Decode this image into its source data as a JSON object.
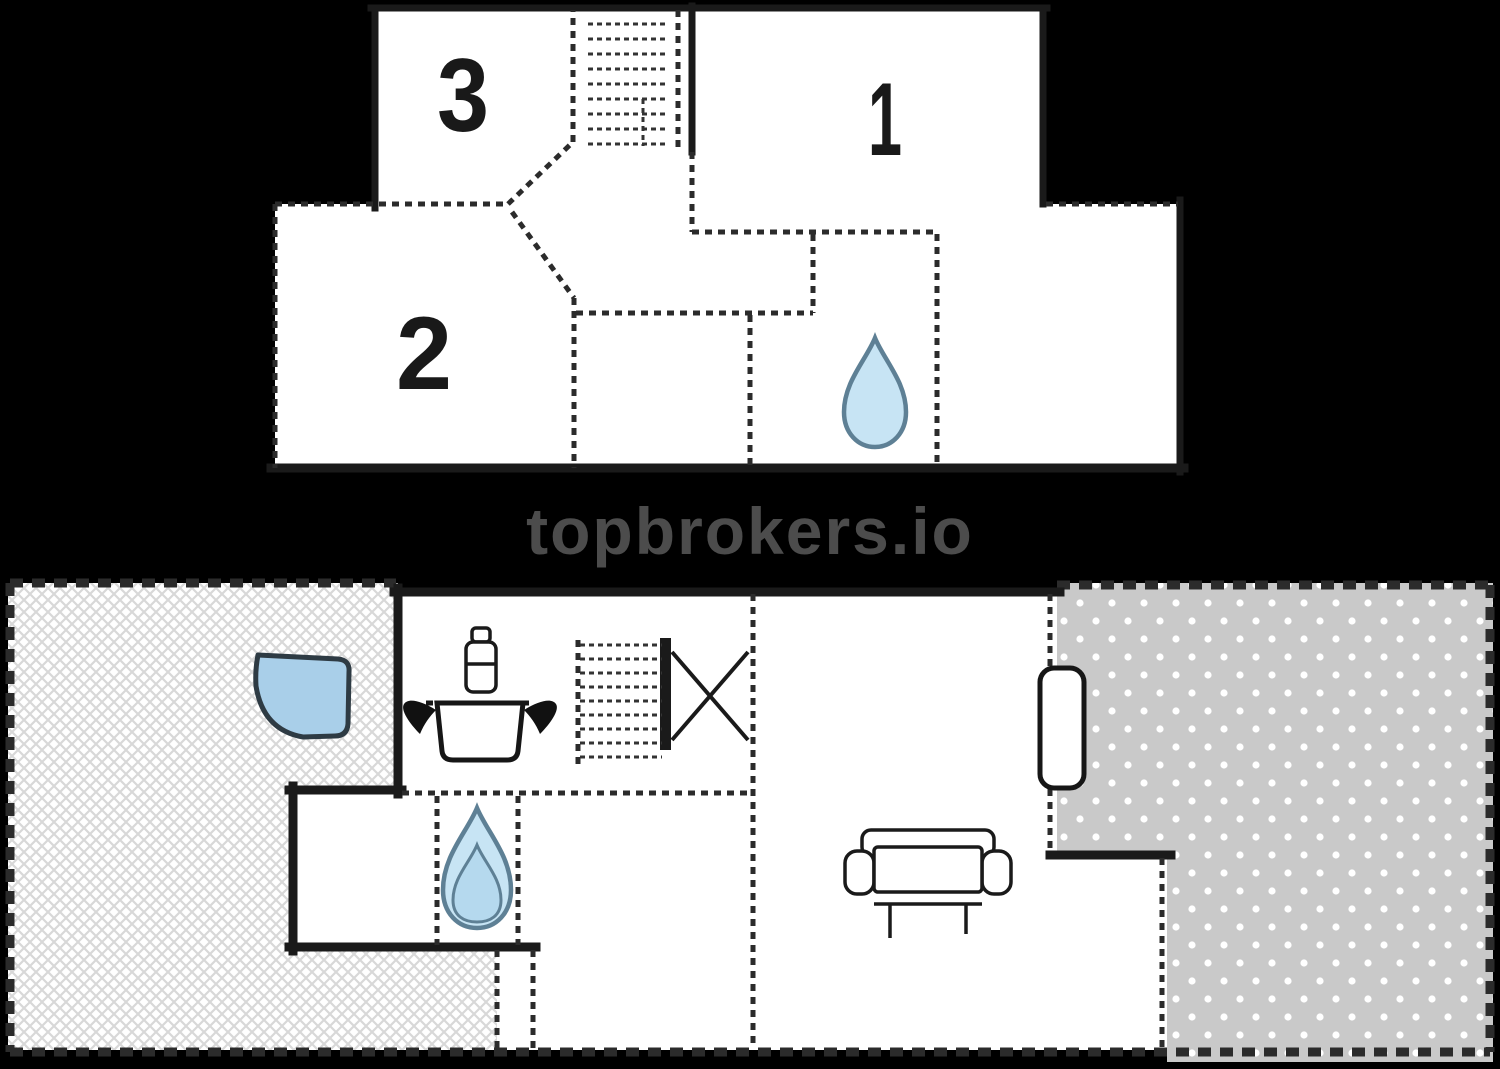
{
  "watermark": {
    "text": "topbrokers.io"
  },
  "upper_floor": {
    "rooms": [
      {
        "label": "1"
      },
      {
        "label": "2"
      },
      {
        "label": "3"
      }
    ],
    "icons": [
      "staircase-icon",
      "water-drop-icon"
    ]
  },
  "ground_floor": {
    "icons": [
      "staircase-icon",
      "water-drop-icon",
      "cooking-pot-icon",
      "faucet-icon",
      "corner-bathtub-icon",
      "sofa-icon",
      "door-leaf-icon",
      "cross-marker-icon"
    ],
    "areas": [
      "terrace-hatched",
      "terrace-dotted"
    ]
  },
  "colors": {
    "background": "#000000",
    "plan_fill": "#ffffff",
    "wall": "#1a1a1a",
    "partition_dash": "#2b2b2b",
    "watermark_gray": "#4c4c4c",
    "water_fill": "#c7e4f4",
    "water_stroke": "#5e8095",
    "water_inner": "#b5d9ee",
    "corner_bath_blue": "#a9cfe9",
    "terrace_dot_gray": "#c9c9c9",
    "hatch_gray": "#d8d8d8"
  }
}
